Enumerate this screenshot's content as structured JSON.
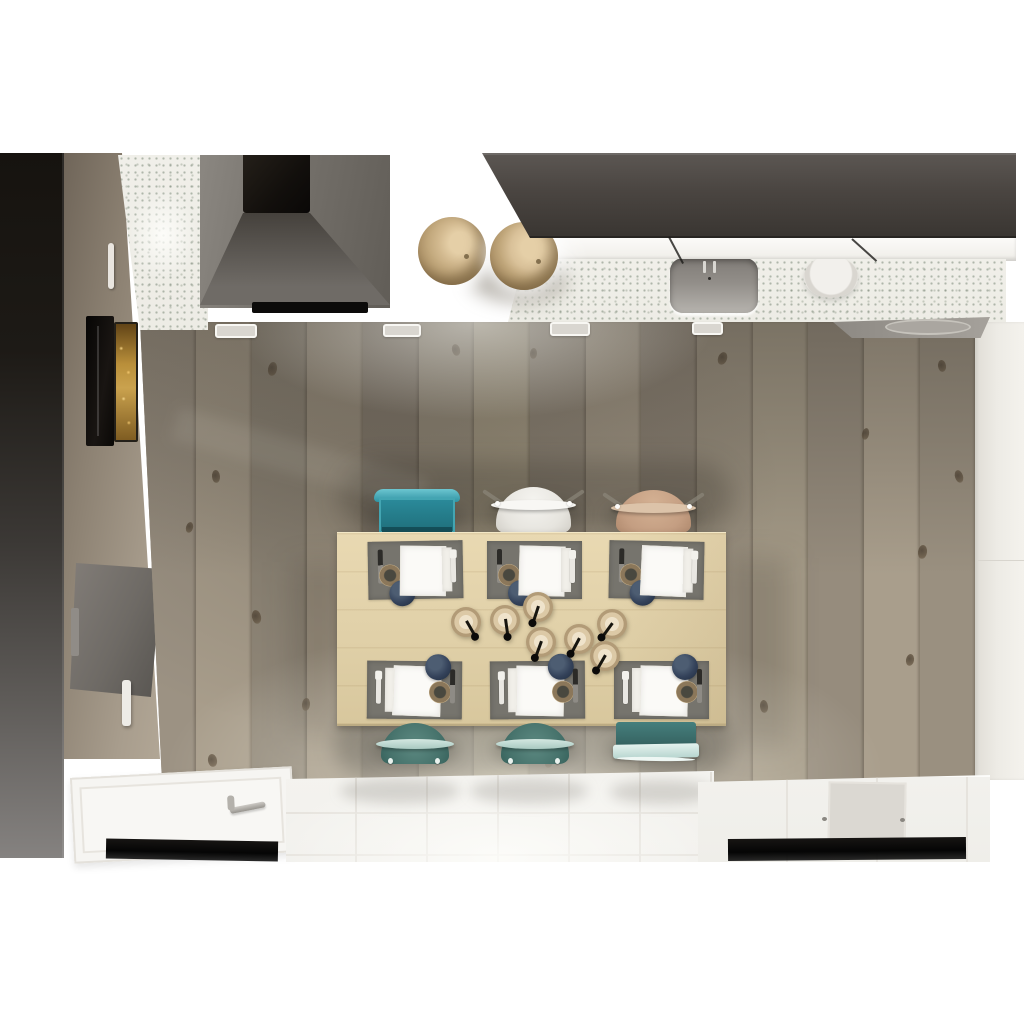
{
  "scene": {
    "description": "Top-down 3D interior render of a kitchen and dining room with island table set for six",
    "colors": {
      "page": "#ffffff",
      "left-column": "#17130f",
      "cabinet": "#a89d8d",
      "oven-amber": "#caa24e",
      "hood": "#736f69",
      "chimney": "#120f0c",
      "cooktop": "#0c0b0a",
      "upper-band": "#4a4541",
      "shelf": "#f8f7f4",
      "counter-speckle": "#f0efe9",
      "sink": "#928e89",
      "bowl": "#efede9",
      "stool-wood": "#d2b98f",
      "wall": "#edebe5",
      "table": "#e0d0a8",
      "placemat": "#76746d",
      "napkin": "#fbfaf7",
      "navy-bowl": "#34425a",
      "rope": "#c0aa84",
      "teal-chair": "#2f93a3",
      "white-chair": "#eeece7",
      "tan-chair": "#c49e82",
      "teal-dome-chair": "#47736c",
      "bench-glass": "#cfe6e1",
      "tile-floor": "#f3f2ef",
      "door-platform": "#f6f5f2",
      "dark-strip": "#0d0c0b"
    },
    "floor": {
      "x": 140,
      "y": 322,
      "w": 836,
      "h": 460,
      "planks": [
        {
          "x": 0,
          "w": 56,
          "c": "#9c9283"
        },
        {
          "x": 56,
          "w": 56,
          "c": "#a89d8b"
        },
        {
          "x": 112,
          "w": 55,
          "c": "#918879"
        },
        {
          "x": 167,
          "w": 56,
          "c": "#a29785"
        },
        {
          "x": 223,
          "w": 56,
          "c": "#8b8173"
        },
        {
          "x": 279,
          "w": 55,
          "c": "#9e9482"
        },
        {
          "x": 334,
          "w": 56,
          "c": "#aba089"
        },
        {
          "x": 390,
          "w": 56,
          "c": "#948a7b"
        },
        {
          "x": 446,
          "w": 55,
          "c": "#a69b89"
        },
        {
          "x": 501,
          "w": 56,
          "c": "#8e8476"
        },
        {
          "x": 557,
          "w": 56,
          "c": "#9b9180"
        },
        {
          "x": 613,
          "w": 55,
          "c": "#a49a87"
        },
        {
          "x": 668,
          "w": 56,
          "c": "#968c7d"
        },
        {
          "x": 724,
          "w": 56,
          "c": "#a99e8c"
        },
        {
          "x": 780,
          "w": 56,
          "c": "#9a9080"
        }
      ],
      "knots": [
        {
          "x": 128,
          "y": 40,
          "w": 9,
          "h": 14,
          "r": 10
        },
        {
          "x": 312,
          "y": 22,
          "w": 8,
          "h": 12,
          "r": -15
        },
        {
          "x": 390,
          "y": 26,
          "w": 7,
          "h": 11,
          "r": 5
        },
        {
          "x": 578,
          "y": 30,
          "w": 9,
          "h": 13,
          "r": 20
        },
        {
          "x": 798,
          "y": 38,
          "w": 8,
          "h": 12,
          "r": -8
        },
        {
          "x": 722,
          "y": 106,
          "w": 7,
          "h": 12,
          "r": 12
        },
        {
          "x": 815,
          "y": 148,
          "w": 8,
          "h": 13,
          "r": -18
        },
        {
          "x": 778,
          "y": 223,
          "w": 9,
          "h": 14,
          "r": 8
        },
        {
          "x": 72,
          "y": 148,
          "w": 8,
          "h": 13,
          "r": -5
        },
        {
          "x": 46,
          "y": 200,
          "w": 7,
          "h": 11,
          "r": 15
        },
        {
          "x": 112,
          "y": 288,
          "w": 9,
          "h": 14,
          "r": -12
        },
        {
          "x": 162,
          "y": 376,
          "w": 8,
          "h": 13,
          "r": 6
        },
        {
          "x": 68,
          "y": 432,
          "w": 9,
          "h": 13,
          "r": -10
        },
        {
          "x": 405,
          "y": 434,
          "w": 8,
          "h": 12,
          "r": 14
        },
        {
          "x": 620,
          "y": 378,
          "w": 8,
          "h": 13,
          "r": -6
        },
        {
          "x": 766,
          "y": 332,
          "w": 8,
          "h": 12,
          "r": 10
        }
      ]
    },
    "stools": [
      {
        "x": 418,
        "y": 217,
        "d": 68,
        "tone": "#d2b98f"
      },
      {
        "x": 490,
        "y": 222,
        "d": 68,
        "tone": "#d9c199"
      }
    ],
    "vents": [
      {
        "x": 215,
        "y": 324,
        "w": 38,
        "h": 10
      },
      {
        "x": 383,
        "y": 324,
        "w": 34,
        "h": 9
      },
      {
        "x": 550,
        "y": 322,
        "w": 36,
        "h": 10
      },
      {
        "x": 692,
        "y": 322,
        "w": 27,
        "h": 9
      }
    ],
    "handle_lines": [
      {
        "x": 668,
        "y": 237,
        "len": 30,
        "r": 28
      },
      {
        "x": 851,
        "y": 239,
        "len": 33,
        "r": 48
      }
    ],
    "faucet_lines": [
      {
        "x": 33,
        "y": 3
      },
      {
        "x": 43,
        "y": 3
      }
    ],
    "placemats": [
      {
        "x": 368,
        "y": 541,
        "r": -1,
        "f": 0
      },
      {
        "x": 487,
        "y": 541,
        "r": 0,
        "f": 0
      },
      {
        "x": 609,
        "y": 541,
        "r": 1,
        "f": 0
      },
      {
        "x": 367,
        "y": 661,
        "r": 0.5,
        "f": 1
      },
      {
        "x": 490,
        "y": 661,
        "r": -0.5,
        "f": 1
      },
      {
        "x": 614,
        "y": 661,
        "r": 0,
        "f": 1
      }
    ],
    "candles": [
      {
        "x": 466,
        "y": 622,
        "a": -30
      },
      {
        "x": 505,
        "y": 620,
        "a": -8
      },
      {
        "x": 538,
        "y": 607,
        "a": 18
      },
      {
        "x": 541,
        "y": 642,
        "a": 20
      },
      {
        "x": 579,
        "y": 639,
        "a": 28
      },
      {
        "x": 612,
        "y": 624,
        "a": 36
      },
      {
        "x": 605,
        "y": 656,
        "a": 30
      }
    ],
    "chairs": [
      {
        "t": "teal-square",
        "x": 372,
        "y": 489,
        "w": 90,
        "h": 44
      },
      {
        "t": "white-dome",
        "x": 491,
        "y": 486,
        "w": 85,
        "h": 47
      },
      {
        "t": "tan-dome",
        "x": 611,
        "y": 489,
        "w": 85,
        "h": 44
      },
      {
        "t": "teal-dome",
        "x": 376,
        "y": 722,
        "w": 78,
        "h": 42
      },
      {
        "t": "teal-dome",
        "x": 496,
        "y": 722,
        "w": 78,
        "h": 42
      },
      {
        "t": "teal-bench",
        "x": 612,
        "y": 722,
        "w": 88,
        "h": 44
      }
    ],
    "tile_reflections": [
      {
        "x": 54,
        "y": 6,
        "w": 120,
        "h": 26
      },
      {
        "x": 184,
        "y": 6,
        "w": 118,
        "h": 26
      },
      {
        "x": 324,
        "y": 8,
        "w": 104,
        "h": 24
      }
    ],
    "drains": [
      {
        "x": 124,
        "y": 40
      },
      {
        "x": 202,
        "y": 41
      }
    ]
  }
}
